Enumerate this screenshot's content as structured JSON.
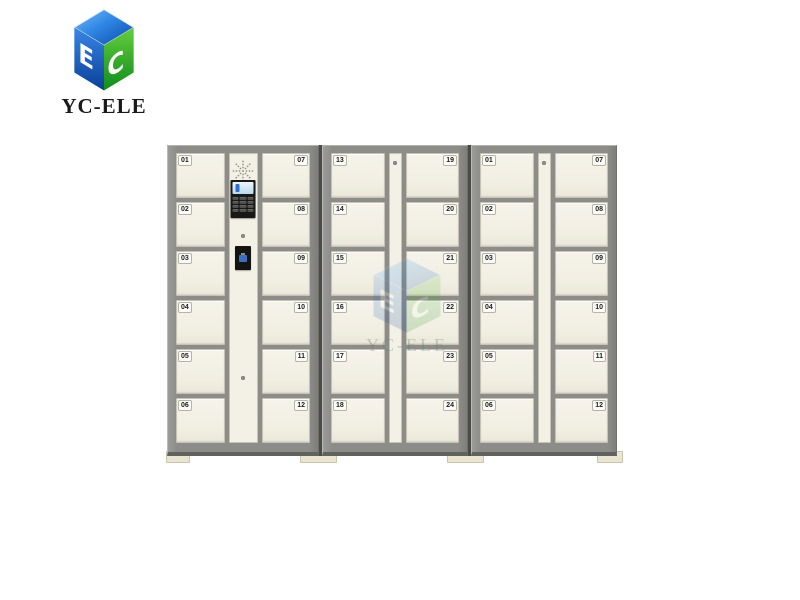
{
  "brand": {
    "logo_text": "YC-ELE",
    "logo_icon": "cube-logo-icon",
    "colors": {
      "blue_light": "#5fb0f0",
      "blue": "#2f86e4",
      "blue_deep": "#0b4aa6",
      "green": "#55c634",
      "green_deep": "#118c1e",
      "text": "#1a1a1a"
    }
  },
  "watermark": {
    "text": "YC-ELE",
    "icon": "cube-logo-icon"
  },
  "locker_bank": {
    "cabinets": [
      {
        "name": "main-cabinet",
        "left_doors": [
          "01",
          "02",
          "03",
          "04",
          "05",
          "06"
        ],
        "right_doors": [
          "07",
          "08",
          "09",
          "10",
          "11",
          "12"
        ],
        "has_control_unit": true
      },
      {
        "name": "extension-cabinet-1",
        "left_doors": [
          "13",
          "14",
          "15",
          "16",
          "17",
          "18"
        ],
        "right_doors": [
          "19",
          "20",
          "21",
          "22",
          "23",
          "24"
        ],
        "has_control_unit": false
      },
      {
        "name": "extension-cabinet-2",
        "left_doors": [
          "01",
          "02",
          "03",
          "04",
          "05",
          "06"
        ],
        "right_doors": [
          "07",
          "08",
          "09",
          "10",
          "11",
          "12"
        ],
        "has_control_unit": false
      }
    ],
    "control_unit_components": [
      "speaker-grille-icon",
      "lcd-screen",
      "keypad",
      "lock-screw",
      "qr-scanner"
    ],
    "colors": {
      "frame": "#8f8f8c",
      "door": "#f3f0e5",
      "seam": "#4a4a46",
      "foot": "#eae5d0",
      "panel": "#181816"
    }
  }
}
